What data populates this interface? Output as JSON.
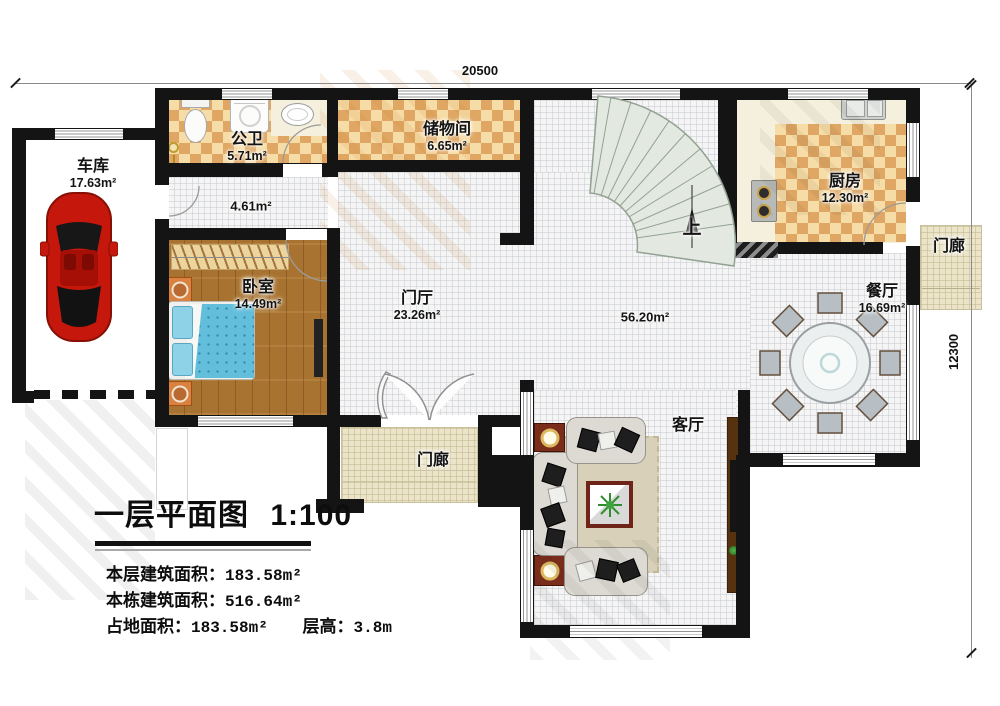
{
  "dimensions": {
    "top": "20500",
    "right": "12300"
  },
  "rooms": {
    "garage": {
      "name": "车库",
      "area": "17.63m²"
    },
    "bathroom": {
      "name": "公卫",
      "area": "5.71m²"
    },
    "hallway": {
      "area": "4.61m²"
    },
    "storage": {
      "name": "储物间",
      "area": "6.65m²"
    },
    "kitchen": {
      "name": "厨房",
      "area": "12.30m²"
    },
    "bedroom": {
      "name": "卧室",
      "area": "14.49m²"
    },
    "foyer": {
      "name": "门厅",
      "area": "23.26m²"
    },
    "hall": {
      "area": "56.20m²"
    },
    "dining": {
      "name": "餐厅",
      "area": "16.69m²"
    },
    "living": {
      "name": "客厅"
    },
    "porch_right": {
      "name": "门廊"
    },
    "porch_bottom": {
      "name": "门廊"
    },
    "stairs": {
      "direction": "上"
    }
  },
  "title_block": {
    "title": "一层平面图",
    "scale": "1:100",
    "lines": [
      {
        "label": "本层建筑面积：",
        "value": "183.58m²"
      },
      {
        "label": "本栋建筑面积：",
        "value": "516.64m²"
      },
      {
        "label": "占地面积：",
        "value": "183.58m²",
        "label2": "层高：",
        "value2": "3.8m"
      }
    ]
  }
}
